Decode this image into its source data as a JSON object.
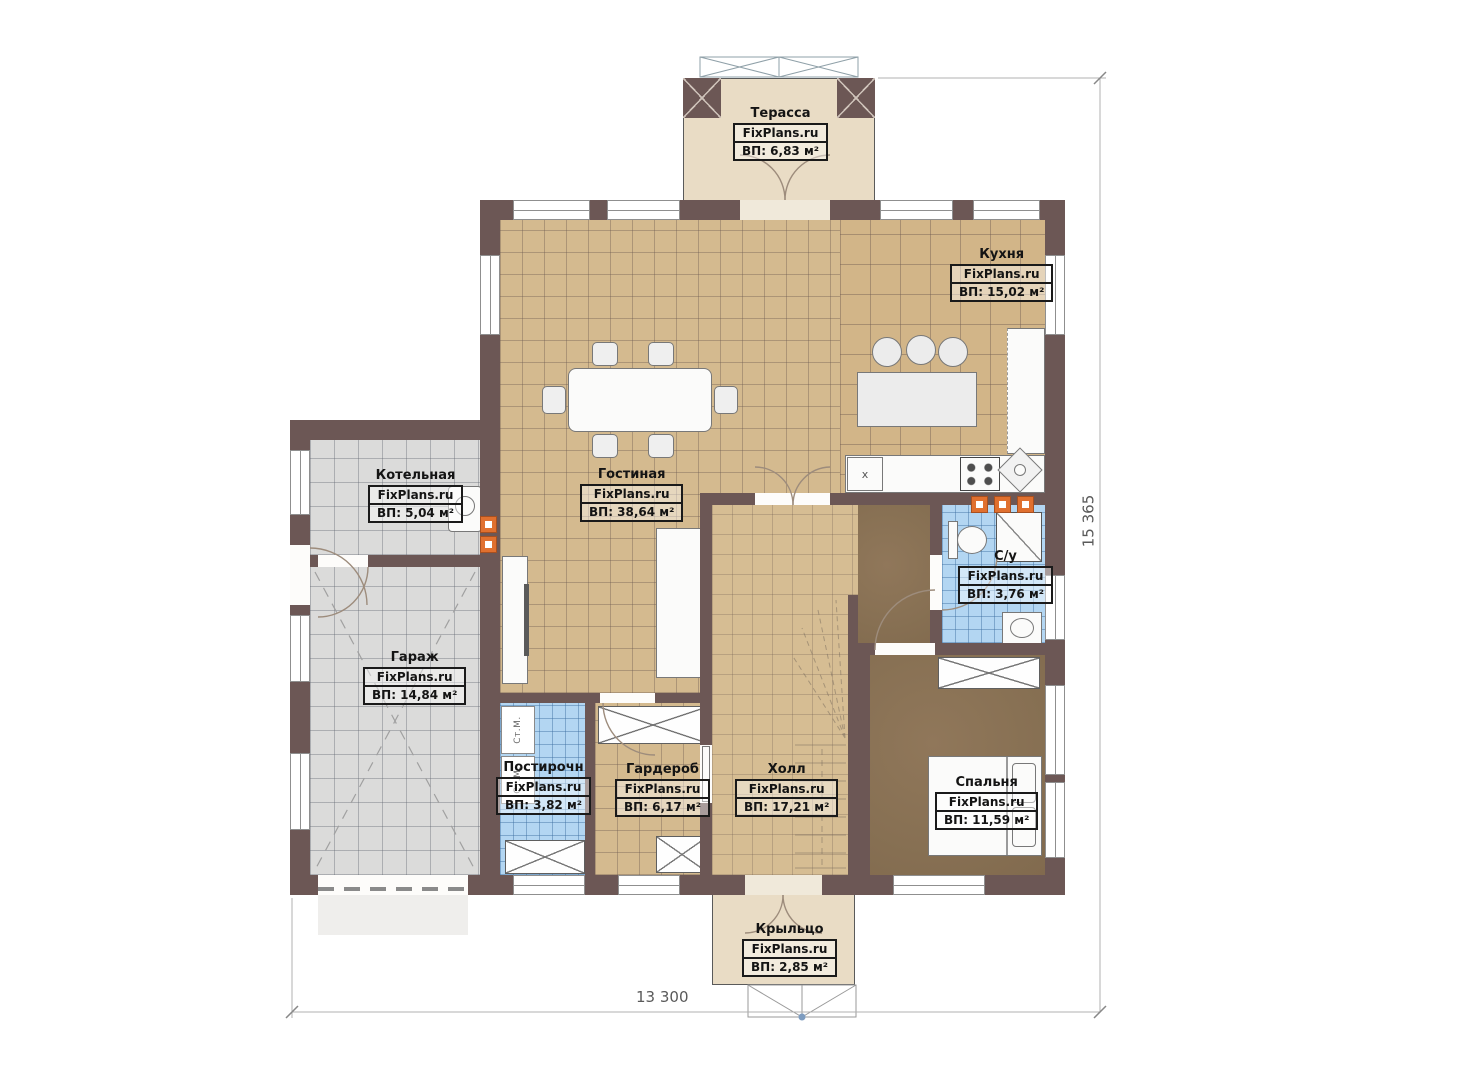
{
  "plan": {
    "brand": "FixPlans.ru",
    "dimensions": {
      "bottom": "13 300",
      "right": "15 365"
    },
    "rooms": [
      {
        "id": "terrace",
        "name": "Терасса",
        "area": "ВП: 6,83 м²"
      },
      {
        "id": "kitchen",
        "name": "Кухня",
        "area": "ВП: 15,02 м²"
      },
      {
        "id": "living",
        "name": "Гостиная",
        "area": "ВП: 38,64 м²"
      },
      {
        "id": "boiler",
        "name": "Котельная",
        "area": "ВП: 5,04 м²"
      },
      {
        "id": "garage",
        "name": "Гараж",
        "area": "ВП: 14,84 м²"
      },
      {
        "id": "laundry",
        "name": "Постирочн",
        "area": "ВП: 3,82 м²"
      },
      {
        "id": "wardrobe",
        "name": "Гардероб",
        "area": "ВП: 6,17 м²"
      },
      {
        "id": "hall",
        "name": "Холл",
        "area": "ВП: 17,21 м²"
      },
      {
        "id": "bedroom",
        "name": "Спальня",
        "area": "ВП: 11,59 м²"
      },
      {
        "id": "bathroom",
        "name": "С/у",
        "area": "ВП: 3,76 м²"
      },
      {
        "id": "porch",
        "name": "Крыльцо",
        "area": "ВП: 2,85 м²"
      }
    ],
    "appliances": {
      "washing_machine": "Ст.М.",
      "kitchen_unit": "x"
    },
    "colors": {
      "wall": "#6c5755",
      "floor_tan": "#d4ba8f",
      "floor_blue": "#b3d6f2",
      "floor_gray": "#dbdbda",
      "floor_dark": "#877053",
      "floor_beige": "#e9dcc5",
      "radiator_orange": "#e0702f"
    }
  }
}
